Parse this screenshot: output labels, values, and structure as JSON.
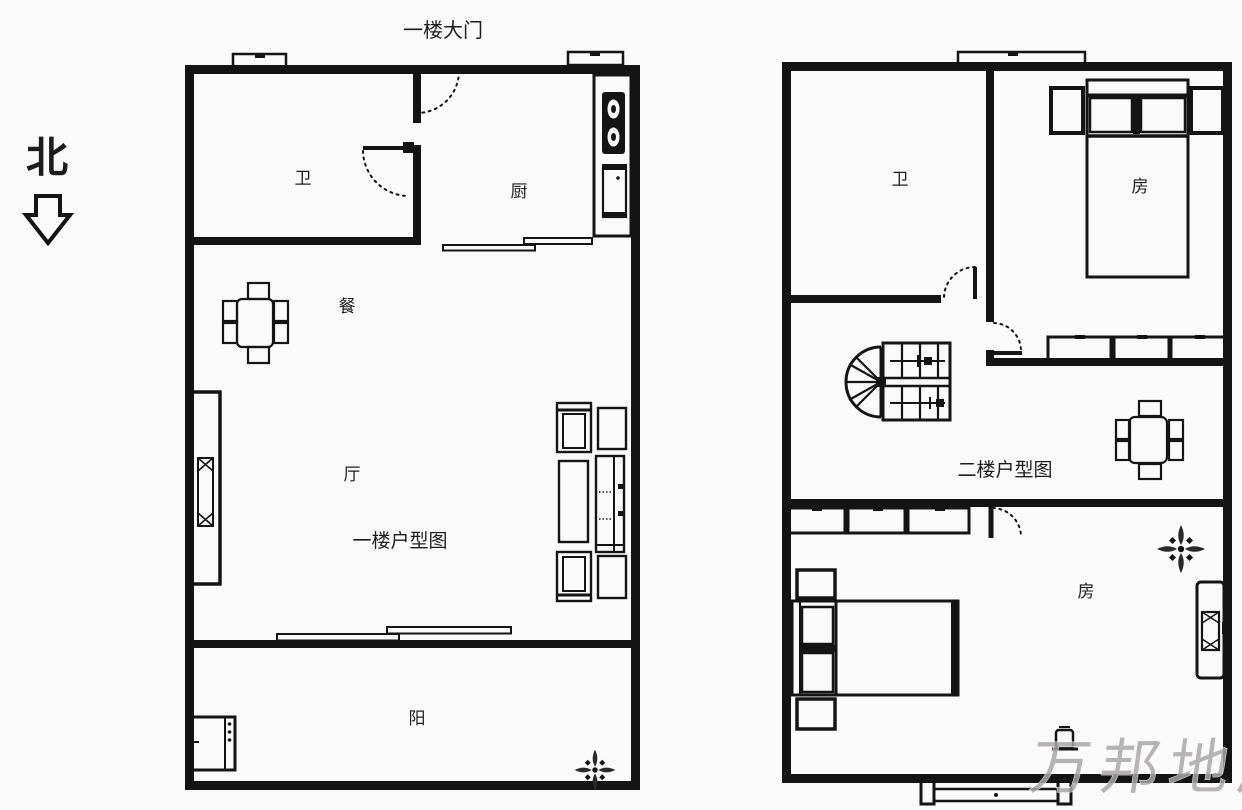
{
  "page": {
    "background": "#fbfafa",
    "line_color": "#141414",
    "watermark_color": "#a9a7a7"
  },
  "north": {
    "label": "北"
  },
  "entrance": {
    "label": "一楼大门"
  },
  "floor1": {
    "title": "一楼户型图",
    "rooms": {
      "bathroom": "卫",
      "kitchen": "厨",
      "dining": "餐",
      "living": "厅",
      "balcony": "阳"
    }
  },
  "floor2": {
    "title": "二楼户型图",
    "rooms": {
      "bathroom": "卫",
      "bedroom_top": "房",
      "bedroom_bottom": "房"
    }
  },
  "watermark": {
    "text": "万邦地产"
  }
}
